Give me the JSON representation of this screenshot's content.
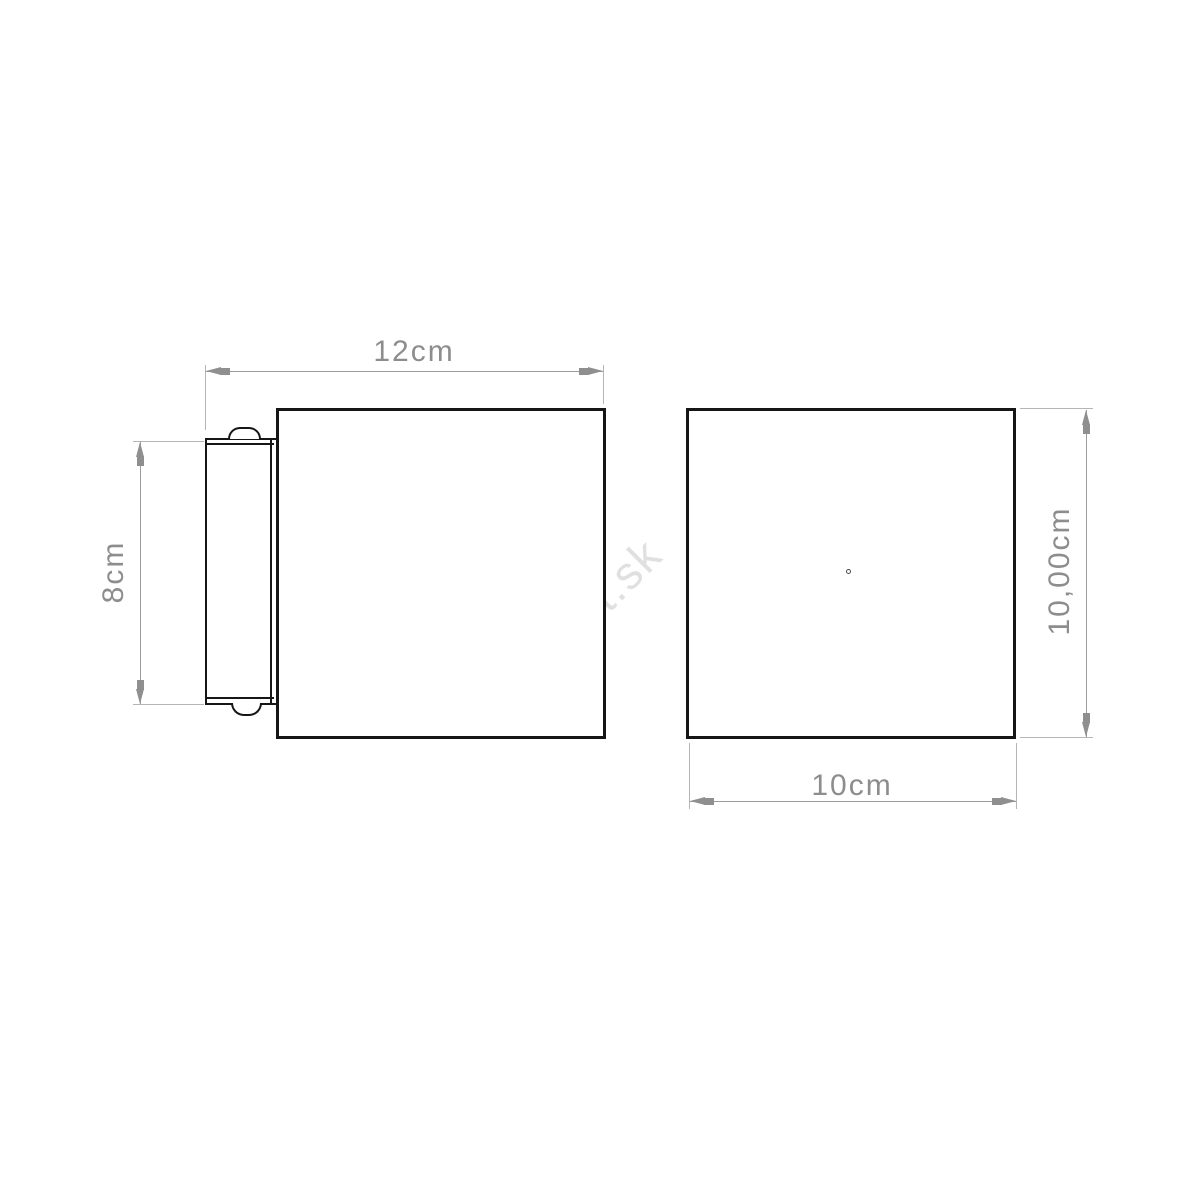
{
  "drawing": {
    "watermark": "rent.sk",
    "side_view": {
      "width_label": "12cm",
      "height_label": "8cm"
    },
    "front_view": {
      "height_label": "10,00cm",
      "width_label": "10cm"
    },
    "colors": {
      "outline": "#161616",
      "dimension_line": "#9b9b9b",
      "dimension_text": "#8d8d8d",
      "watermark": "#e0e0e0"
    }
  }
}
